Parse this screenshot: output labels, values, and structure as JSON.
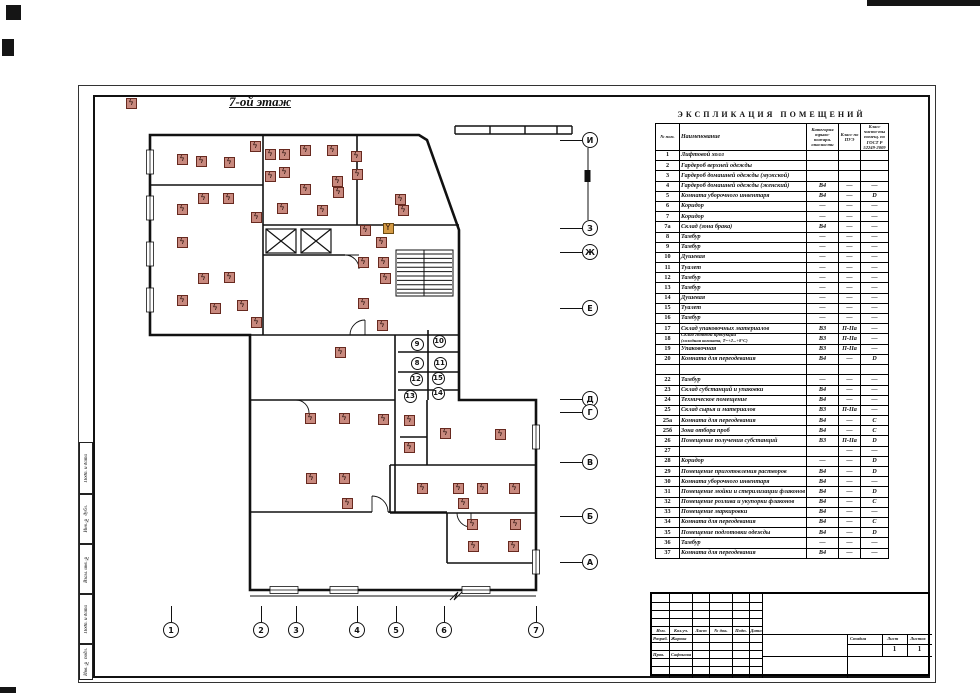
{
  "plan": {
    "title": "7-ой этаж",
    "marker": {
      "glyph": "ϟ",
      "fill": "#c8897e",
      "border": "#67291f"
    },
    "markers": [
      [
        131,
        103
      ],
      [
        182,
        159
      ],
      [
        201,
        161
      ],
      [
        229,
        162
      ],
      [
        255,
        146
      ],
      [
        270,
        154
      ],
      [
        284,
        154
      ],
      [
        305,
        150
      ],
      [
        332,
        150
      ],
      [
        356,
        156
      ],
      [
        270,
        176
      ],
      [
        284,
        172
      ],
      [
        357,
        174
      ],
      [
        337,
        181
      ],
      [
        338,
        192
      ],
      [
        305,
        189
      ],
      [
        203,
        198
      ],
      [
        228,
        198
      ],
      [
        282,
        208
      ],
      [
        322,
        210
      ],
      [
        400,
        199
      ],
      [
        182,
        209
      ],
      [
        256,
        217
      ],
      [
        403,
        210
      ],
      [
        365,
        230
      ],
      [
        381,
        242
      ],
      [
        182,
        242
      ],
      [
        363,
        262
      ],
      [
        383,
        262
      ],
      [
        385,
        278
      ],
      [
        203,
        278
      ],
      [
        229,
        277
      ],
      [
        182,
        300
      ],
      [
        215,
        308
      ],
      [
        242,
        305
      ],
      [
        363,
        303
      ],
      [
        256,
        322
      ],
      [
        382,
        325
      ],
      [
        340,
        352
      ],
      [
        310,
        418
      ],
      [
        344,
        418
      ],
      [
        383,
        419
      ],
      [
        409,
        420
      ],
      [
        445,
        433
      ],
      [
        500,
        434
      ],
      [
        409,
        447
      ],
      [
        311,
        478
      ],
      [
        344,
        478
      ],
      [
        422,
        488
      ],
      [
        458,
        488
      ],
      [
        482,
        488
      ],
      [
        514,
        488
      ],
      [
        347,
        503
      ],
      [
        463,
        503
      ],
      [
        472,
        524
      ],
      [
        515,
        524
      ],
      [
        473,
        546
      ],
      [
        513,
        546
      ]
    ],
    "special_marker": {
      "x": 388,
      "y": 228,
      "glyph": "Y"
    },
    "room_numbers": [
      {
        "n": "9",
        "x": 417,
        "y": 344
      },
      {
        "n": "10",
        "x": 439,
        "y": 341
      },
      {
        "n": "8",
        "x": 417,
        "y": 363
      },
      {
        "n": "11",
        "x": 440,
        "y": 363
      },
      {
        "n": "12",
        "x": 416,
        "y": 379
      },
      {
        "n": "15",
        "x": 438,
        "y": 378
      },
      {
        "n": "13",
        "x": 410,
        "y": 396
      },
      {
        "n": "14",
        "x": 438,
        "y": 393
      }
    ],
    "axis_right": [
      {
        "label": "И",
        "y": 140
      },
      {
        "label": "З",
        "y": 228
      },
      {
        "label": "Ж",
        "y": 252
      },
      {
        "label": "Е",
        "y": 308
      },
      {
        "label": "Д",
        "y": 399
      },
      {
        "label": "Г",
        "y": 412
      },
      {
        "label": "В",
        "y": 462
      },
      {
        "label": "Б",
        "y": 516
      },
      {
        "label": "А",
        "y": 562
      }
    ],
    "axis_right_x": 588,
    "axis_bottom": [
      {
        "label": "1",
        "x": 171
      },
      {
        "label": "2",
        "x": 261
      },
      {
        "label": "3",
        "x": 296
      },
      {
        "label": "4",
        "x": 357
      },
      {
        "label": "5",
        "x": 396
      },
      {
        "label": "6",
        "x": 444
      },
      {
        "label": "7",
        "x": 536
      }
    ],
    "axis_bottom_y": 628
  },
  "explication": {
    "title": "ЭКСПЛИКАЦИЯ   ПОМЕЩЕНИЙ",
    "headers": {
      "num": "№ пом.",
      "name": "Наименование",
      "cat": "Категория взрыво-пожарн. опасности",
      "pue": "Класс по ПУЭ",
      "clean": "Класс чисто-ты помещ. по ГОСТ Р 52249-2009"
    },
    "rows": [
      {
        "n": "1",
        "name": "Лифтовой холл",
        "cat": "",
        "pue": "",
        "cln": ""
      },
      {
        "n": "2",
        "name": "Гардероб верхней одежды",
        "cat": "",
        "pue": "",
        "cln": ""
      },
      {
        "n": "3",
        "name": "Гардероб домашней одежды (мужской)",
        "cat": "",
        "pue": "",
        "cln": ""
      },
      {
        "n": "4",
        "name": "Гардероб домашней одежды (женский)",
        "cat": "В4",
        "pue": "—",
        "cln": "—"
      },
      {
        "n": "5",
        "name": "Комната уборочного инвентаря",
        "cat": "В4",
        "pue": "—",
        "cln": "D"
      },
      {
        "n": "6",
        "name": "Коридор",
        "cat": "—",
        "pue": "—",
        "cln": "—"
      },
      {
        "n": "7",
        "name": "Коридор",
        "cat": "—",
        "pue": "—",
        "cln": "—"
      },
      {
        "n": "7а",
        "name": "Склад (зона брака)",
        "cat": "В4",
        "pue": "—",
        "cln": "—"
      },
      {
        "n": "8",
        "name": "Тамбур",
        "cat": "—",
        "pue": "—",
        "cln": "—"
      },
      {
        "n": "9",
        "name": "Тамбур",
        "cat": "—",
        "pue": "—",
        "cln": "—"
      },
      {
        "n": "10",
        "name": "Душевая",
        "cat": "—",
        "pue": "—",
        "cln": "—"
      },
      {
        "n": "11",
        "name": "Туалет",
        "cat": "—",
        "pue": "—",
        "cln": "—"
      },
      {
        "n": "12",
        "name": "Тамбур",
        "cat": "—",
        "pue": "—",
        "cln": "—"
      },
      {
        "n": "13",
        "name": "Тамбур",
        "cat": "—",
        "pue": "—",
        "cln": "—"
      },
      {
        "n": "14",
        "name": "Душевая",
        "cat": "—",
        "pue": "—",
        "cln": "—"
      },
      {
        "n": "15",
        "name": "Туалет",
        "cat": "—",
        "pue": "—",
        "cln": "—"
      },
      {
        "n": "16",
        "name": "Тамбур",
        "cat": "—",
        "pue": "—",
        "cln": "—"
      },
      {
        "n": "17",
        "name": "Склад упаковочных материалов",
        "cat": "В3",
        "pue": "П-IIа",
        "cln": "—"
      },
      {
        "n": "18",
        "name": "Склад готовой продукции",
        "name2": "(холодная комната, Т=+2...+8°С)",
        "cat": "В3",
        "pue": "П-IIа",
        "cln": "—"
      },
      {
        "n": "19",
        "name": "Упаковочная",
        "cat": "В3",
        "pue": "П-IIа",
        "cln": "—"
      },
      {
        "n": "20",
        "name": "Комната для переодевания",
        "cat": "В4",
        "pue": "—",
        "cln": "D"
      },
      {
        "n": "",
        "name": "",
        "cat": "",
        "pue": "",
        "cln": ""
      },
      {
        "n": "22",
        "name": "Тамбур",
        "cat": "—",
        "pue": "—",
        "cln": "—"
      },
      {
        "n": "23",
        "name": "Склад субстанций и упаковки",
        "cat": "В4",
        "pue": "—",
        "cln": "—"
      },
      {
        "n": "24",
        "name": "Техническое помещение",
        "cat": "В4",
        "pue": "—",
        "cln": "—"
      },
      {
        "n": "25",
        "name": "Склад сырья и материалов",
        "cat": "В3",
        "pue": "П-IIа",
        "cln": "—"
      },
      {
        "n": "25а",
        "name": "Комната для переодевания",
        "cat": "В4",
        "pue": "—",
        "cln": "С"
      },
      {
        "n": "25б",
        "name": "Зона отбора проб",
        "cat": "В4",
        "pue": "—",
        "cln": "С"
      },
      {
        "n": "26",
        "name": "Помещение получения субстанций",
        "cat": "В3",
        "pue": "П-IIа",
        "cln": "D"
      },
      {
        "n": "27",
        "name": "",
        "cat": "",
        "pue": "—",
        "cln": "—"
      },
      {
        "n": "28",
        "name": "Коридор",
        "cat": "—",
        "pue": "—",
        "cln": "D"
      },
      {
        "n": "29",
        "name": "Помещение приготовления растворов",
        "cat": "В4",
        "pue": "—",
        "cln": "D"
      },
      {
        "n": "30",
        "name": "Комната уборочного инвентаря",
        "cat": "В4",
        "pue": "—",
        "cln": "—"
      },
      {
        "n": "31",
        "name": "Помещение мойки и стерилизации флаконов",
        "cat": "В4",
        "pue": "—",
        "cln": "D"
      },
      {
        "n": "32",
        "name": "Помещение розлива и укупорки флаконов",
        "cat": "В4",
        "pue": "—",
        "cln": "С"
      },
      {
        "n": "33",
        "name": "Помещение маркировки",
        "cat": "В4",
        "pue": "—",
        "cln": "—"
      },
      {
        "n": "34",
        "name": "Комната для переодевания",
        "cat": "В4",
        "pue": "—",
        "cln": "С"
      },
      {
        "n": "35",
        "name": "Помещение подготовки одежды",
        "cat": "В4",
        "pue": "—",
        "cln": "D"
      },
      {
        "n": "36",
        "name": "Тамбур",
        "cat": "—",
        "pue": "—",
        "cln": "—"
      },
      {
        "n": "37",
        "name": "Комната для переодевания",
        "cat": "В4",
        "pue": "—",
        "cln": "—"
      }
    ]
  },
  "title_block": {
    "header_cells": [
      "Изм.",
      "Кол.уч.",
      "Лист",
      "№ док.",
      "Подп.",
      "Дата"
    ],
    "sign_rows": [
      {
        "role": "Разраб.",
        "name": "Жарова"
      },
      {
        "role": "Пров.",
        "name": "Сафонова"
      }
    ],
    "stage_label": "Стадия",
    "sheet_label": "Лист",
    "sheets_label": "Листов",
    "sheet_value": "1",
    "sheets_value": "1"
  },
  "margin_labels": [
    "Подп. и дата",
    "Инв. № дубл.",
    "Взам. инв. №",
    "Подп. и дата",
    "Инв. № подл."
  ]
}
